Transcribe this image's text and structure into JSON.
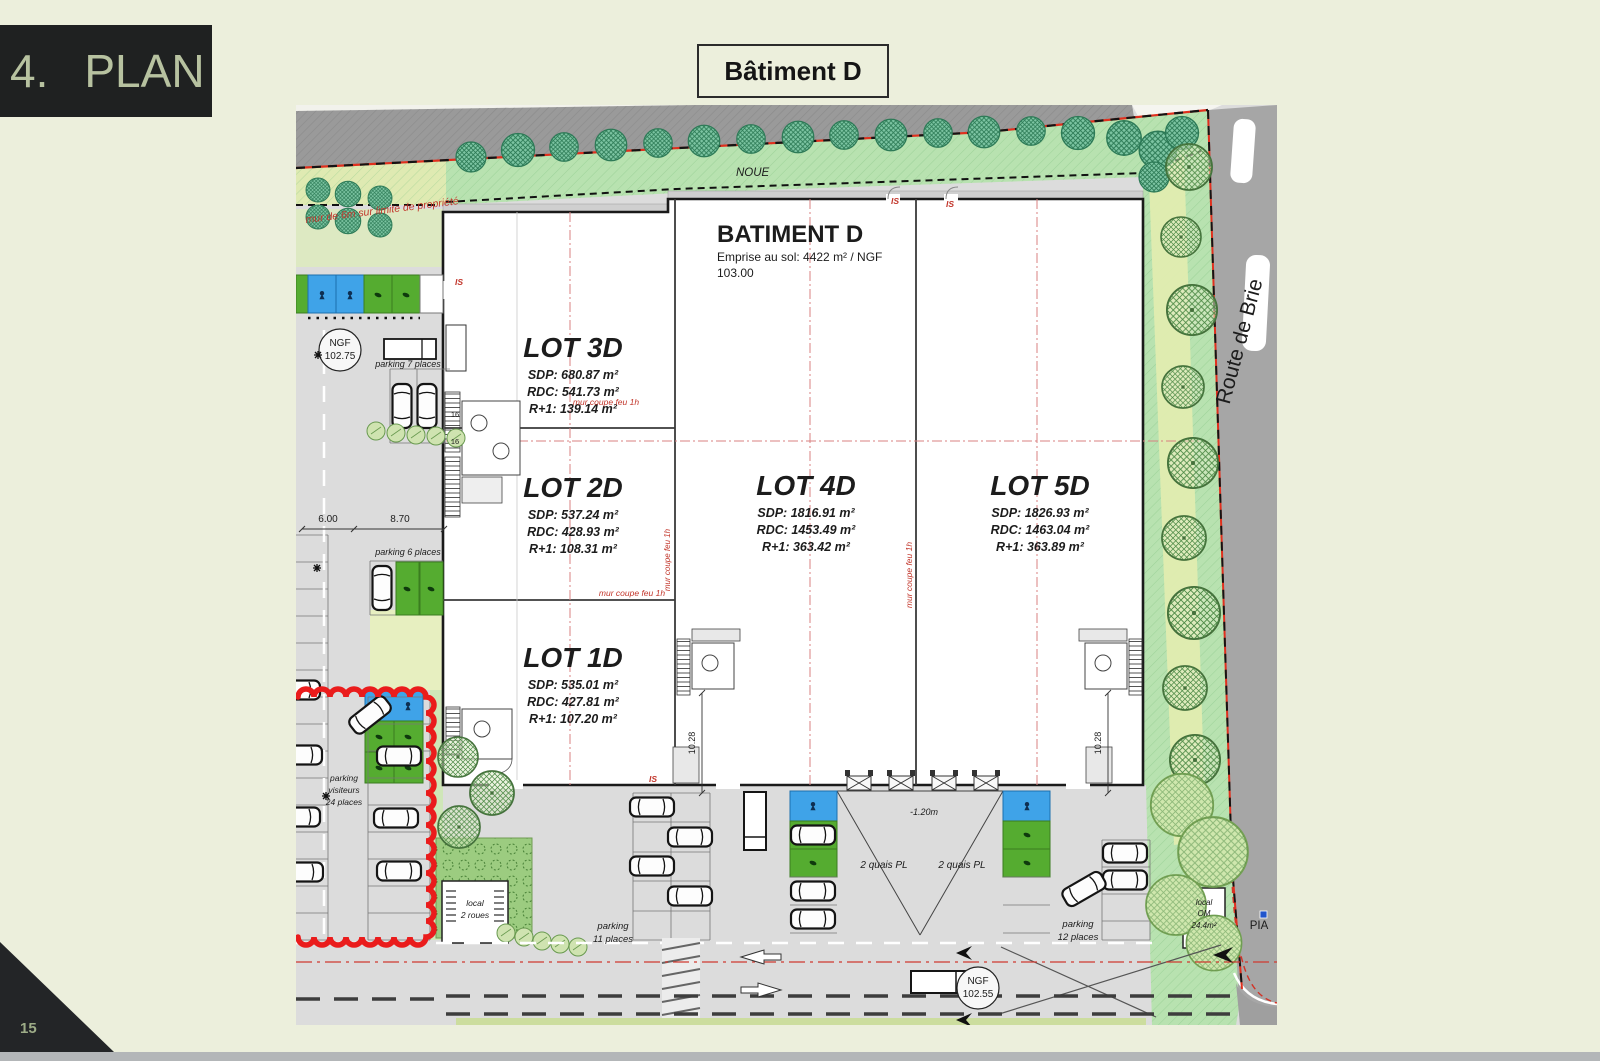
{
  "slide": {
    "section_number": "4.",
    "section_title": "PLAN",
    "page_number": "15"
  },
  "header": {
    "title": "Bâtiment D"
  },
  "plan": {
    "building": {
      "name": "BATIMENT D",
      "area_line1": "Emprise au sol: 4422 m² / NGF",
      "area_line2": "103.00"
    },
    "lots": [
      {
        "name": "LOT 3D",
        "sdp": "SDP: 680.87 m²",
        "rdc": "RDC: 541.73 m²",
        "r1": "R+1: 139.14 m²"
      },
      {
        "name": "LOT 2D",
        "sdp": "SDP: 537.24 m²",
        "rdc": "RDC: 428.93 m²",
        "r1": "R+1: 108.31 m²"
      },
      {
        "name": "LOT 1D",
        "sdp": "SDP: 535.01 m²",
        "rdc": "RDC: 427.81 m²",
        "r1": "R+1: 107.20 m²"
      },
      {
        "name": "LOT 4D",
        "sdp": "SDP: 1816.91 m²",
        "rdc": "RDC: 1453.49 m²",
        "r1": "R+1: 363.42 m²"
      },
      {
        "name": "LOT 5D",
        "sdp": "SDP: 1826.93 m²",
        "rdc": "RDC: 1463.04 m²",
        "r1": "R+1: 363.89 m²"
      }
    ],
    "streets": {
      "route_de_brie": "Route de Brie"
    },
    "annotations": {
      "noue": "NOUE",
      "mur_limite": "mur de 6m sur limite de propriété",
      "mur_coupe_feu": "mur coupe feu 1h",
      "is_marker": "IS",
      "level_delta": "-1.20m",
      "ngf_west": {
        "line1": "NGF",
        "line2": "102.75"
      },
      "ngf_south": {
        "line1": "NGF",
        "line2": "102.55"
      }
    },
    "parking": {
      "p7": "parking 7 places",
      "p6": "parking 6 places",
      "visitors": {
        "line1": "parking",
        "line2": "visiteurs",
        "line3": "24 places"
      },
      "p11": {
        "line1": "parking",
        "line2": "11 places"
      },
      "p12": {
        "line1": "parking",
        "line2": "12 places"
      },
      "quais_left": "2 quais PL",
      "quais_right": "2 quais PL",
      "local_bikes": {
        "line1": "local",
        "line2": "2 roues"
      },
      "local_om": {
        "line1": "local",
        "line2": "OM",
        "line3": "24.4m²"
      },
      "pia": "PIA"
    },
    "dimensions": {
      "d_6_00": "6.00",
      "d_8_70": "8.70",
      "d_10_28": "10.28",
      "d_16": "16"
    }
  },
  "colors": {
    "page_bg": "#ecefdc",
    "banner_bg": "#1f2121",
    "banner_fg": "#b7c2a0",
    "accent_red": "#e53125",
    "green_light": "#b8e2b0",
    "green_yellow": "#dfeab2",
    "cell_green": "#55ac30",
    "cell_blue": "#3fa3e8",
    "road_gray": "#a6a6a6",
    "neighbor_gray": "#999999",
    "asphalt": "#dcdcdc"
  }
}
